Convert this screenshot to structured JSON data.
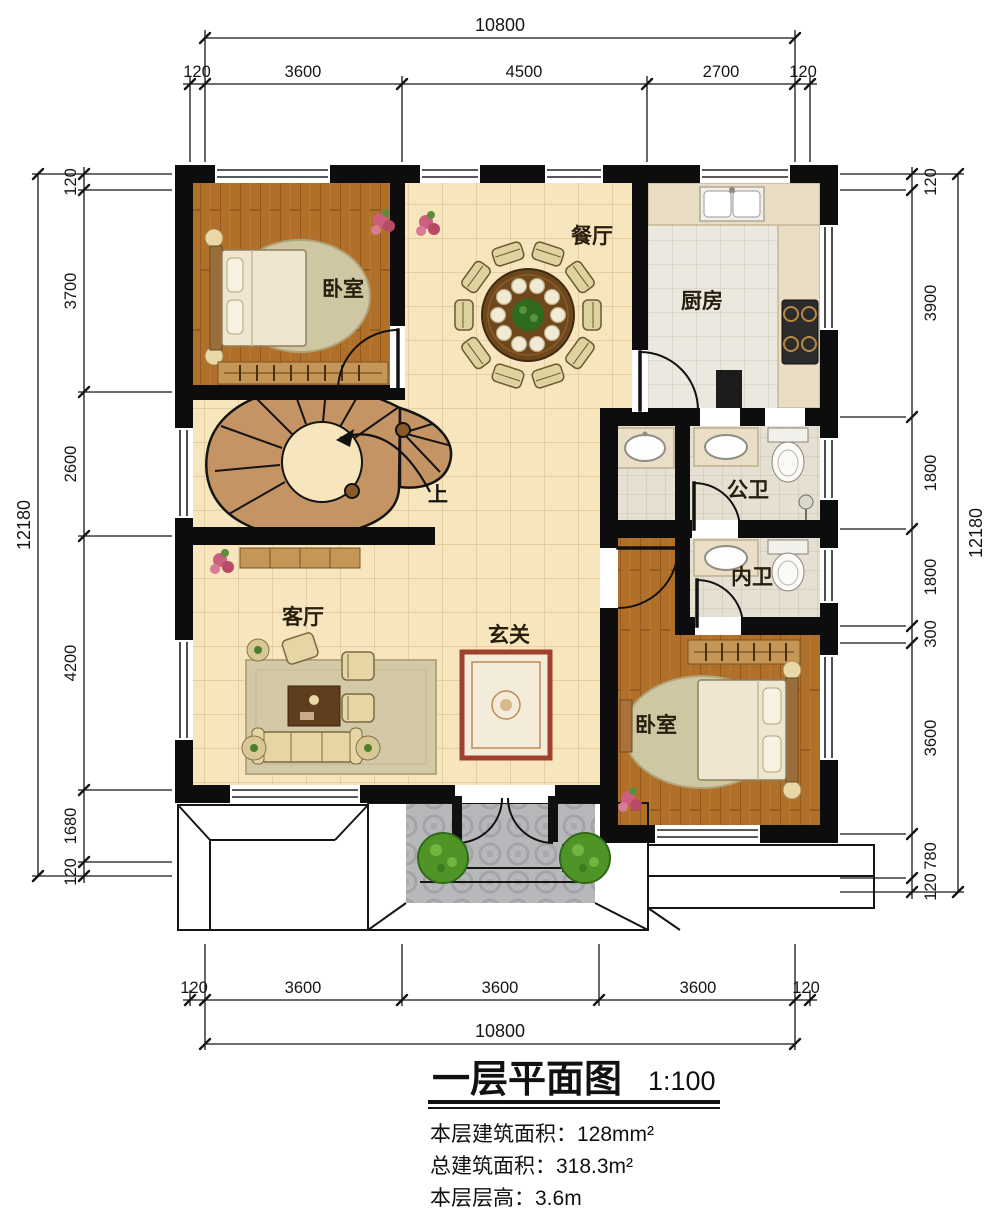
{
  "title_block": {
    "title": "一层平面图",
    "scale": "1:100",
    "info_lines": [
      "本层建筑面积：128mm²",
      "总建筑面积：318.3m²",
      "本层层高：3.6m"
    ]
  },
  "rooms": {
    "bedroom_tl": "卧室",
    "dining": "餐厅",
    "kitchen": "厨房",
    "bath_public": "公卫",
    "bath_private": "内卫",
    "living": "客厅",
    "foyer": "玄关",
    "bedroom_br": "卧室",
    "stair_up": "上"
  },
  "dimensions": {
    "top": {
      "total": "10800",
      "segments": [
        "120",
        "3600",
        "4500",
        "2700",
        "120"
      ]
    },
    "bottom": {
      "total": "10800",
      "segments": [
        "120",
        "3600",
        "3600",
        "3600",
        "120"
      ]
    },
    "left": {
      "total": "12180",
      "segments": [
        "120",
        "3700",
        "2600",
        "4200",
        "1680",
        "120"
      ]
    },
    "right": {
      "total": "12180",
      "segments": [
        "120",
        "3900",
        "1800",
        "1800",
        "300",
        "3600",
        "780",
        "120"
      ]
    }
  },
  "features": {
    "icons": [
      "dining-table-icon",
      "bed-icon",
      "wardrobe-icon",
      "sofa-icon",
      "toilet-icon",
      "sink-icon",
      "stove-icon",
      "stair-icon",
      "bush-icon",
      "rug-icon"
    ]
  },
  "colors": {
    "wall": "#0d0d0d",
    "floor_tile": "#f6e5bd",
    "wood_floor": "#b1702a",
    "kitchen_tile": "#ebe8e0",
    "bath_tile": "#e6e0d2",
    "porch_tile": "#b7b8ba",
    "stair": "#c49465",
    "greenery": "#4f9426",
    "dim_text": "#161616"
  }
}
